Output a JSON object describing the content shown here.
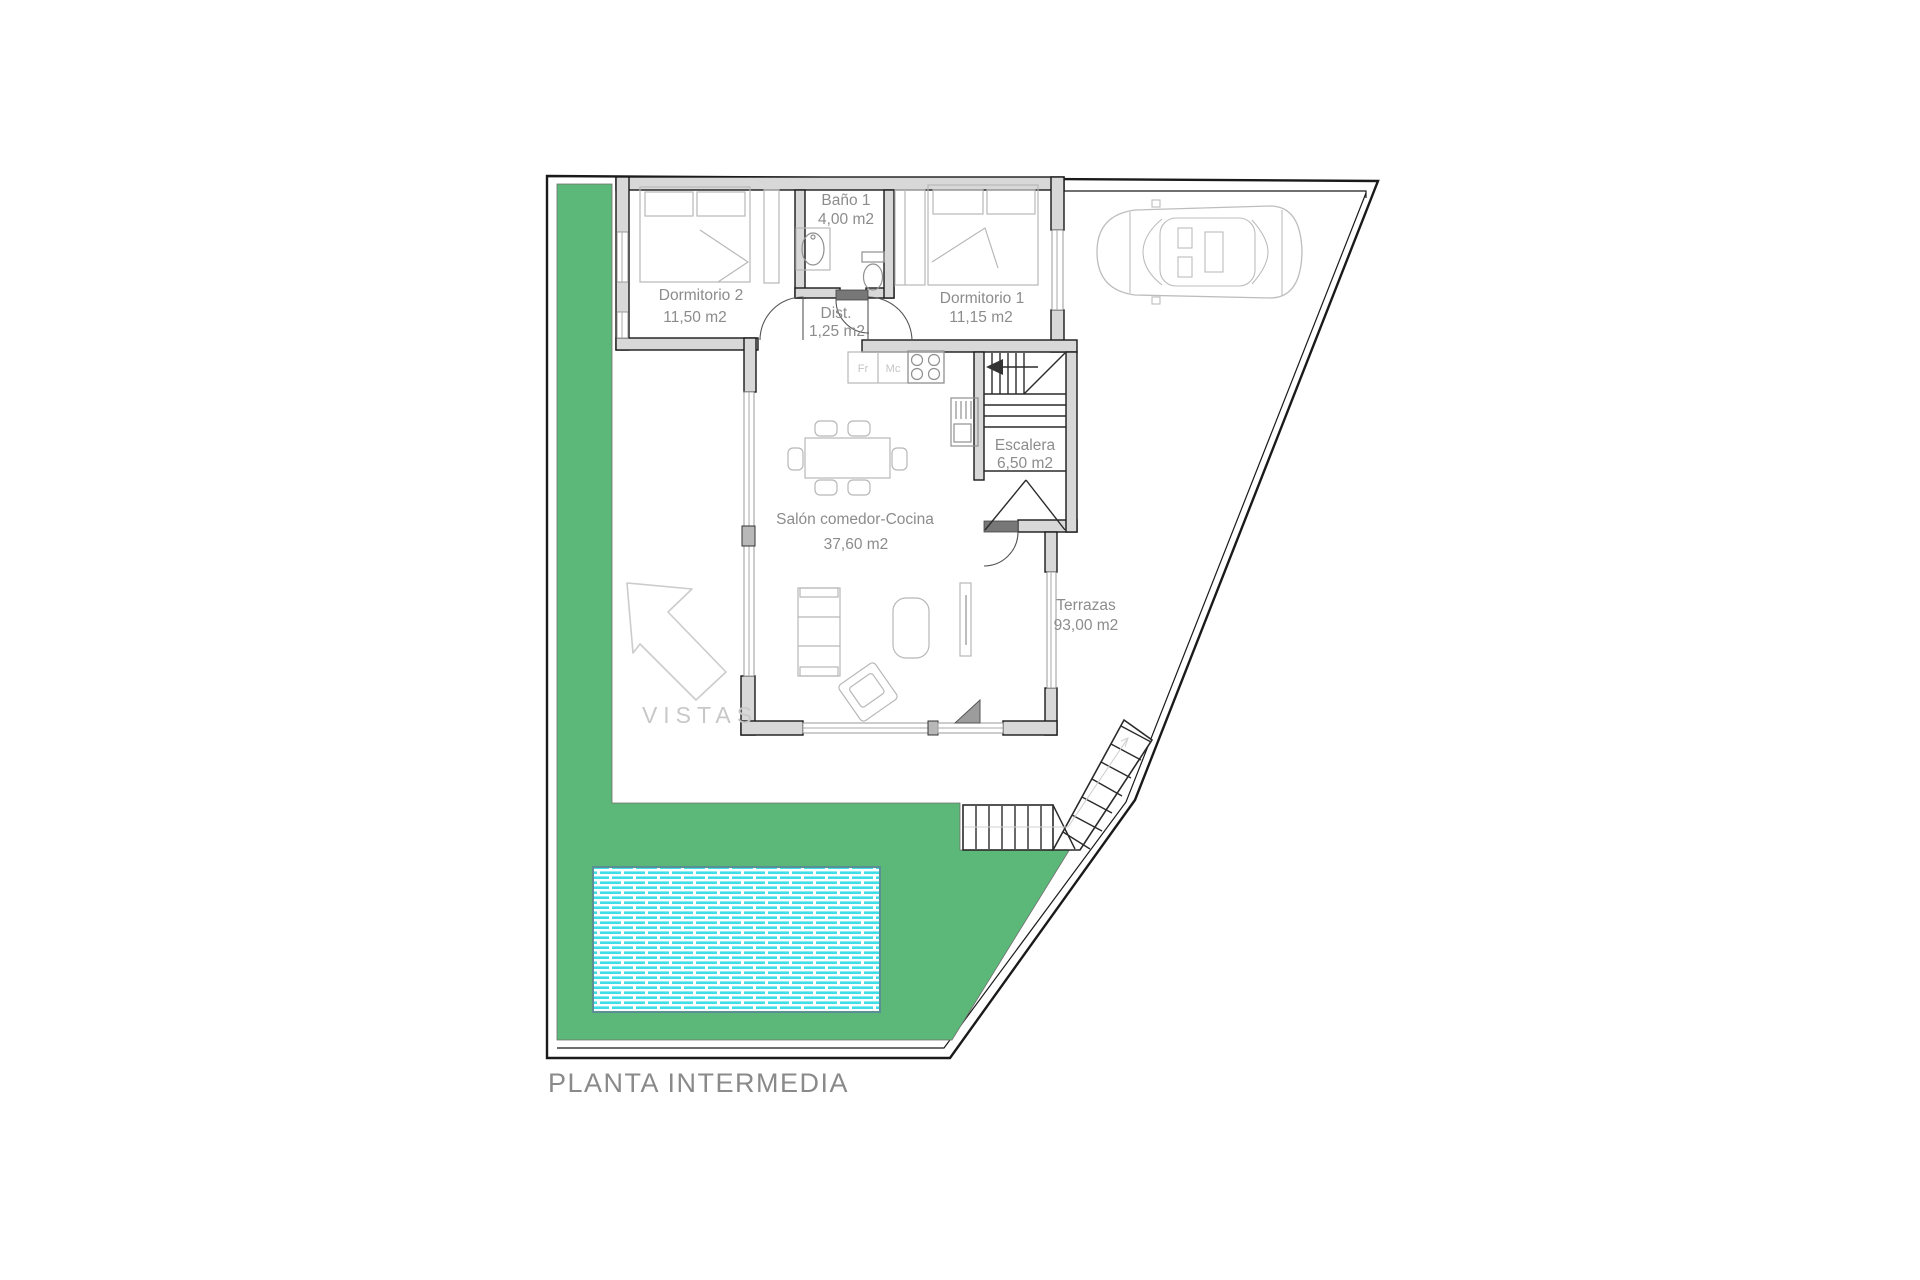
{
  "title": "PLANTA INTERMEDIA",
  "colors": {
    "garden-green": "#5CB878",
    "pool-cyan": "#3FDDE8",
    "pool-border": "#5B8F96",
    "wall-fill": "#D8D8D8",
    "wall-stroke": "#1A1A1A",
    "boundary": "#1A1A1A",
    "furniture": "#B8B8B8",
    "label-gray": "#8C8C8C",
    "faint-gray": "#C8C8C8"
  },
  "rooms": [
    {
      "name": "Baño 1",
      "area": "4,00 m2"
    },
    {
      "name": "Dormitorio 2",
      "area": "11,50 m2"
    },
    {
      "name": "Dist.",
      "area": "1,25 m2"
    },
    {
      "name": "Dormitorio 1",
      "area": "11,15 m2"
    },
    {
      "name": "Escalera",
      "area": "6,50 m2"
    },
    {
      "name": "Salón comedor-Cocina",
      "area": "37,60 m2"
    },
    {
      "name": "Terrazas",
      "area": "93,00 m2"
    }
  ],
  "annotations": {
    "vistas": "VISTAS",
    "fridge": "Fr",
    "microwave": "Mc"
  }
}
